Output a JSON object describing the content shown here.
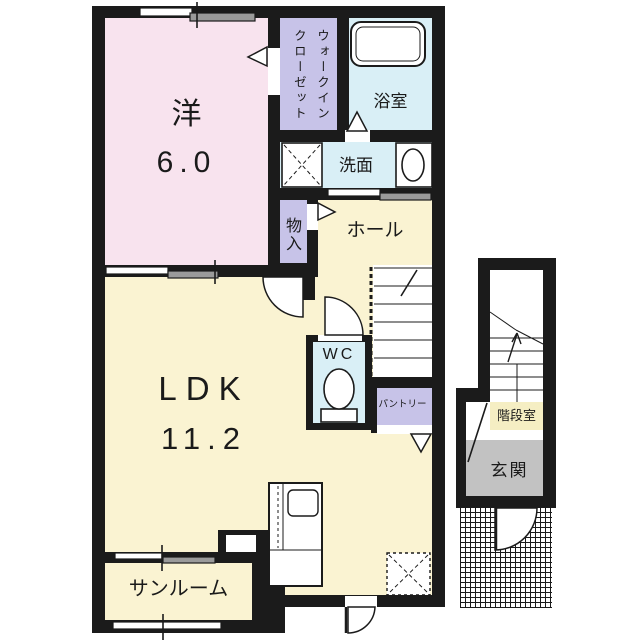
{
  "colors": {
    "wall": "#1b1b1b",
    "room_pink": "#f8e3ee",
    "room_cream": "#faf3d2",
    "room_lavender": "#c7c3e8",
    "room_blue": "#d9eff6",
    "room_gray": "#c2c2c2",
    "label_cream": "#f5eec3",
    "window_gray": "#9a9a9a"
  },
  "rooms": {
    "western_room": {
      "name_label": "洋",
      "size_label": "6.0"
    },
    "walk_in_closet": {
      "label": "ウォークインクローゼット"
    },
    "bathroom": {
      "label": "浴室"
    },
    "washroom": {
      "label": "洗面"
    },
    "storage": {
      "label": "物入"
    },
    "hall": {
      "label": "ホール"
    },
    "wc": {
      "label": "WC"
    },
    "pantry": {
      "label": "パントリー"
    },
    "ldk": {
      "name_label": "LDK",
      "size_label": "11.2"
    },
    "sunroom": {
      "label": "サンルーム"
    },
    "stair_room": {
      "label": "階段室"
    },
    "entrance": {
      "label": "玄関"
    }
  },
  "fixtures": [
    "bathtub",
    "toilet",
    "washbasin",
    "washing-machine-pan",
    "kitchen-counter-with-sink",
    "refrigerator-space",
    "main-staircase",
    "annex-staircase",
    "entry-porch",
    "door-swing-arcs",
    "door-direction-triangles",
    "sliding-windows"
  ]
}
